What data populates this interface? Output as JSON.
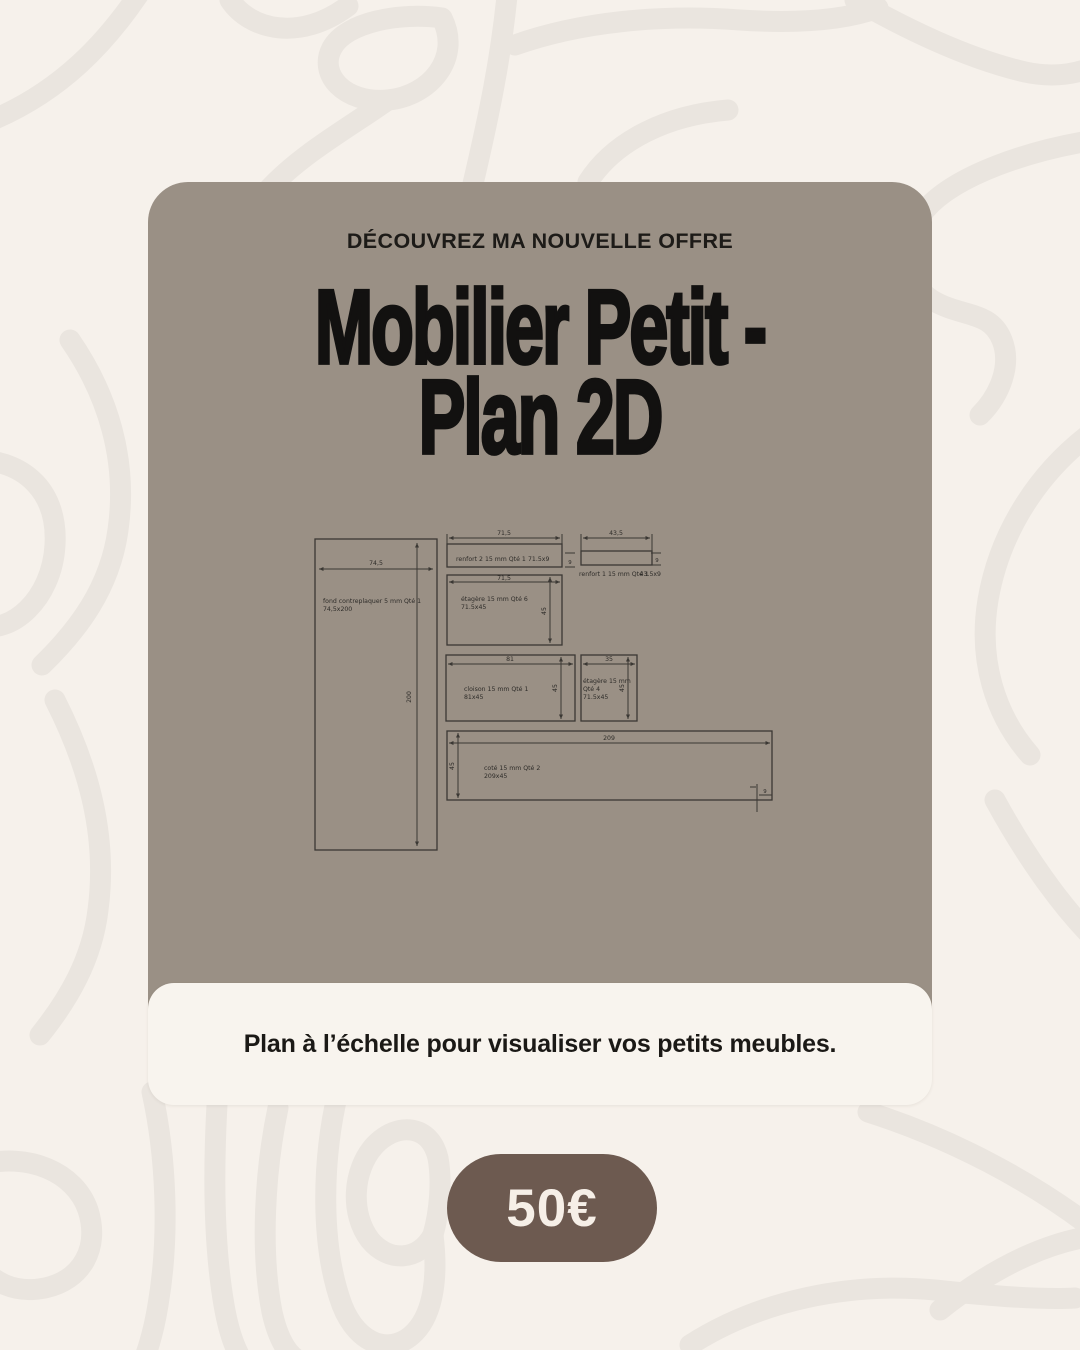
{
  "card": {
    "eyebrow": "DÉCOUVREZ MA NOUVELLE OFFRE",
    "title_line1": "Mobilier Petit -",
    "title_line2": "Plan 2D",
    "caption": "Plan à l’échelle pour visualiser vos petits meubles."
  },
  "price": {
    "label": "50€"
  },
  "plan": {
    "fond": {
      "name": "fond contreplaquer 5 mm Qté 1",
      "size": "74,5x200",
      "dim_w": "74,5",
      "dim_h": "200"
    },
    "renfort2": {
      "name": "renfort 2 15 mm Qté 1",
      "size": "71.5x9",
      "dim_w": "71,5",
      "dim_t": "9"
    },
    "renfort1": {
      "name": "renfort 1 15 mm Qté 1",
      "size": "43.5x9",
      "dim_w": "43,5",
      "dim_t": "9"
    },
    "etagere6": {
      "name": "étagère 15 mm Qté 6",
      "size": "71.5x45",
      "dim_w": "71,5",
      "dim_h": "45"
    },
    "cloison": {
      "name": "cloison 15 mm Qté 1",
      "size": "81x45",
      "dim_w": "81",
      "dim_h": "45"
    },
    "etagere4": {
      "name": "étagère 15 mm",
      "qty": "Qté 4",
      "size": "71.5x45",
      "dim_w": "35",
      "dim_h": "45"
    },
    "cote": {
      "name": "coté 15 mm Qté 2",
      "size": "209x45",
      "dim_w": "209",
      "dim_h": "45",
      "dim_edge": "9"
    }
  },
  "colors": {
    "background": "#f6f1eb",
    "squiggle": "#eae5df",
    "card": "#9a9085",
    "ink": "#121110",
    "plan_line": "#3b3834",
    "caption_bg": "#f8f4ee",
    "pill": "#6d5a50",
    "pill_text": "#f6efe7"
  }
}
